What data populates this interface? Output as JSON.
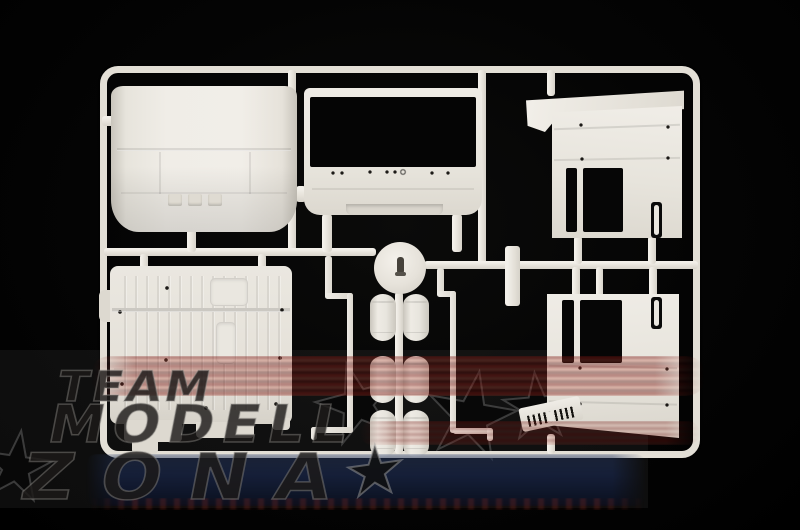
{
  "scene": {
    "subject": "White injection-molded model-kit sprue with truck cab parts photographed on a black background",
    "background_color": "#000000",
    "plastic_color": "#e9e6df",
    "opening_color": "#060606"
  },
  "watermark": {
    "line1": "TEAM",
    "line2": "MODELL",
    "line3": "ZONA",
    "star": "★",
    "text_color": "#1c1a18",
    "outline_color": "#969390",
    "red_streak_color": "#97281f",
    "blue_streak_color": "#1d2b4e"
  },
  "sprue": {
    "tank_count": 6,
    "parts": [
      "roof panel",
      "cab front panel with windshield opening",
      "sleeper visor strip",
      "sleeper side panel upper right",
      "side panel lower right",
      "cab floor panel",
      "six air tanks",
      "round wheel cover disc",
      "step grille",
      "pipe rods"
    ]
  }
}
